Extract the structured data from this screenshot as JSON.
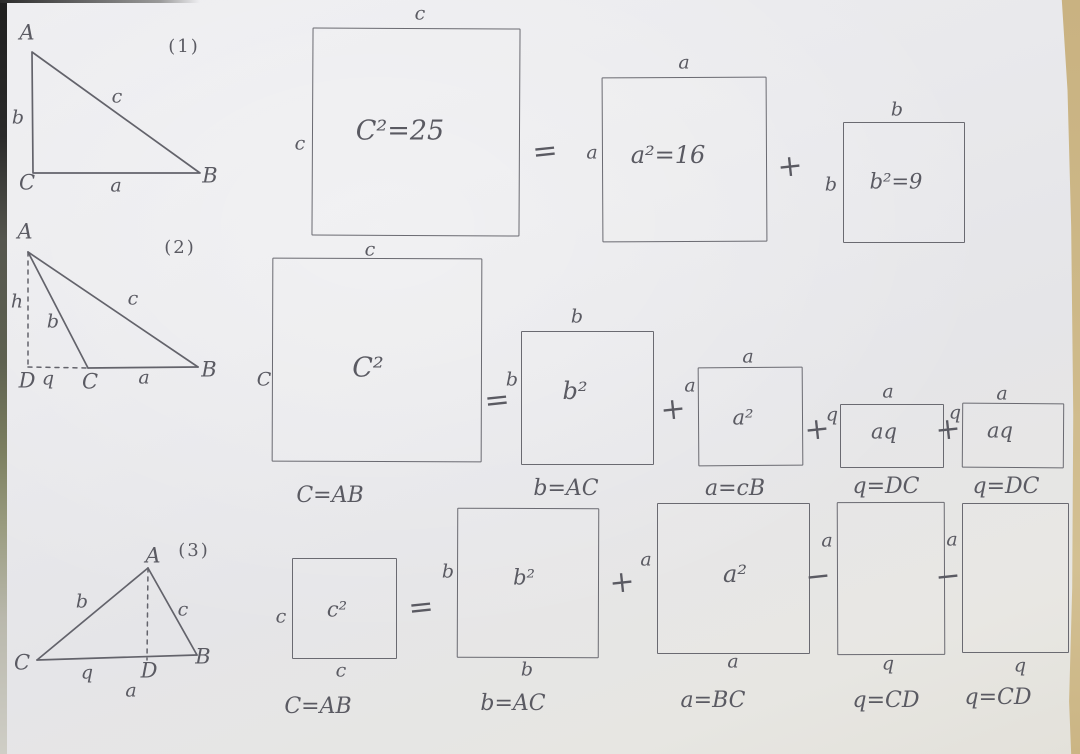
{
  "colors": {
    "paper": "#e9e9ec",
    "pencil": "#5a5a62",
    "table_edge": "#c9b281"
  },
  "fig1": {
    "index": "(1)",
    "tri": {
      "A": "A",
      "B": "B",
      "C": "C",
      "a": "a",
      "b": "b",
      "c": "c"
    },
    "sq_c": {
      "top": "c",
      "left": "c",
      "content": "C²=25"
    },
    "op_eq": "=",
    "sq_a": {
      "top": "a",
      "left": "a",
      "content": "a²=16"
    },
    "op_plus": "+",
    "sq_b": {
      "top": "b",
      "left": "b",
      "content": "b²=9"
    }
  },
  "fig2": {
    "index": "(2)",
    "tri": {
      "A": "A",
      "B": "B",
      "C": "C",
      "D": "D",
      "a": "a",
      "b": "b",
      "c": "c",
      "h": "h",
      "q": "q"
    },
    "sq_c": {
      "top": "c",
      "left": "C",
      "content": "C²",
      "caption": "C=AB"
    },
    "op_eq": "=",
    "sq_b": {
      "top": "b",
      "left": "b",
      "content": "b²",
      "caption": "b=AC"
    },
    "op_plus1": "+",
    "sq_a": {
      "top": "a",
      "left": "a",
      "content": "a²",
      "caption": "a=cB"
    },
    "op_plus2": "+",
    "rect1": {
      "top": "a",
      "left": "q",
      "content": "aq",
      "caption": "q=DC"
    },
    "op_plus3": "+",
    "rect2": {
      "top": "a",
      "left": "q",
      "content": "aq",
      "caption": "q=DC"
    }
  },
  "fig3": {
    "index": "(3)",
    "tri": {
      "A": "A",
      "B": "B",
      "C": "C",
      "D": "D",
      "a": "a",
      "b": "b",
      "c": "c",
      "q": "q"
    },
    "sq_c": {
      "left": "c",
      "bottom": "c",
      "content": "c²",
      "caption": "C=AB"
    },
    "op_eq": "=",
    "sq_b": {
      "left": "b",
      "bottom": "b",
      "content": "b²",
      "caption": "b=AC"
    },
    "op_plus": "+",
    "sq_a": {
      "left": "a",
      "bottom": "a",
      "content": "a²",
      "caption": "a=BC"
    },
    "op_minus1": "−",
    "rect1": {
      "left": "a",
      "bottom": "q",
      "caption": "q=CD"
    },
    "op_minus2": "−",
    "rect2": {
      "left": "a",
      "bottom": "q",
      "caption": "q=CD"
    }
  }
}
